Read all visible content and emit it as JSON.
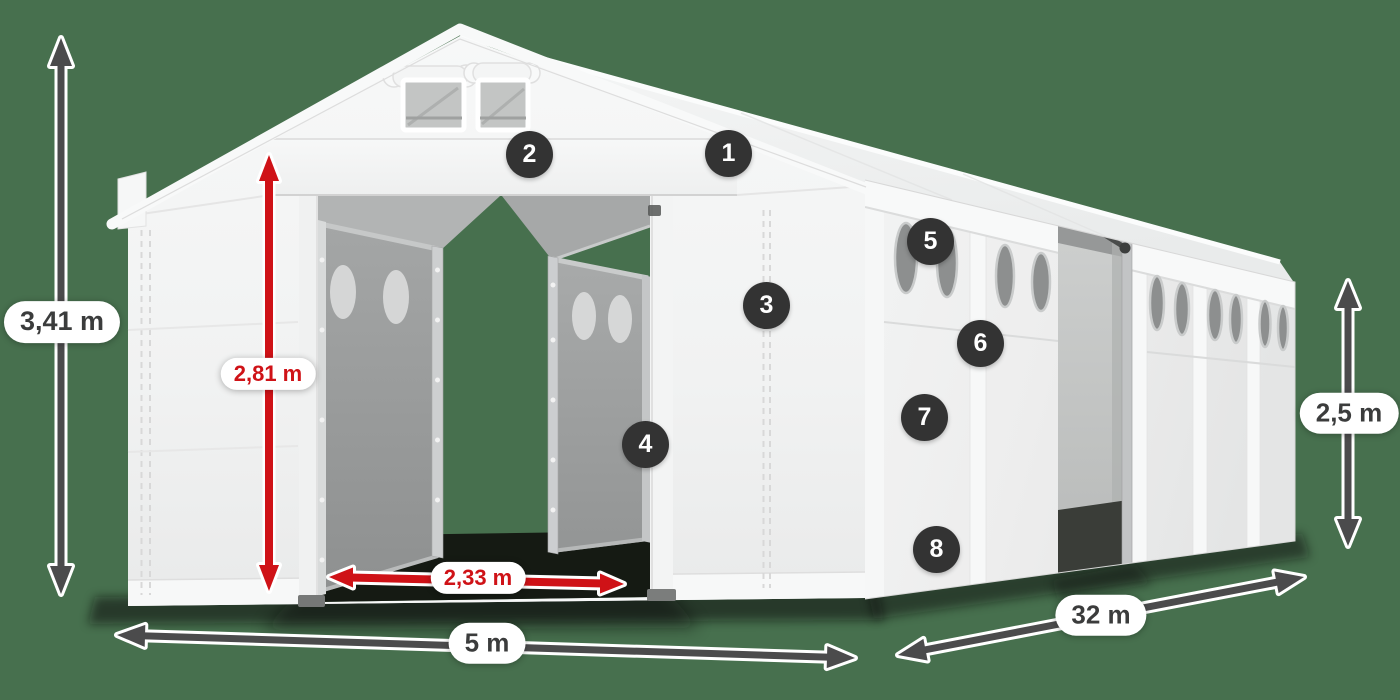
{
  "scene": {
    "description": "White storage marquee tent shown in perspective with dimension arrows and numbered part callouts",
    "background_color": "#47704e"
  },
  "dimensions": {
    "total_height": {
      "label": "3,41 m",
      "style": "dark"
    },
    "door_height": {
      "label": "2,81 m",
      "style": "red"
    },
    "door_width": {
      "label": "2,33 m",
      "style": "red"
    },
    "front_width": {
      "label": "5 m",
      "style": "dark"
    },
    "length": {
      "label": "32 m",
      "style": "dark"
    },
    "side_wall_height": {
      "label": "2,5 m",
      "style": "dark"
    }
  },
  "callouts": {
    "items": [
      {
        "number": "1"
      },
      {
        "number": "2"
      },
      {
        "number": "3"
      },
      {
        "number": "4"
      },
      {
        "number": "5"
      },
      {
        "number": "6"
      },
      {
        "number": "7"
      },
      {
        "number": "8"
      }
    ]
  },
  "colors": {
    "background": "#47704e",
    "arrow_dark": "#4b4b4c",
    "arrow_red": "#cf1217",
    "badge_bg": "#333333",
    "badge_text": "#ffffff",
    "pill_bg": "#ffffff",
    "pill_text_dark": "#3b3c3c",
    "pill_text_red": "#cf1217",
    "tent_white": "#f4f5f5"
  }
}
